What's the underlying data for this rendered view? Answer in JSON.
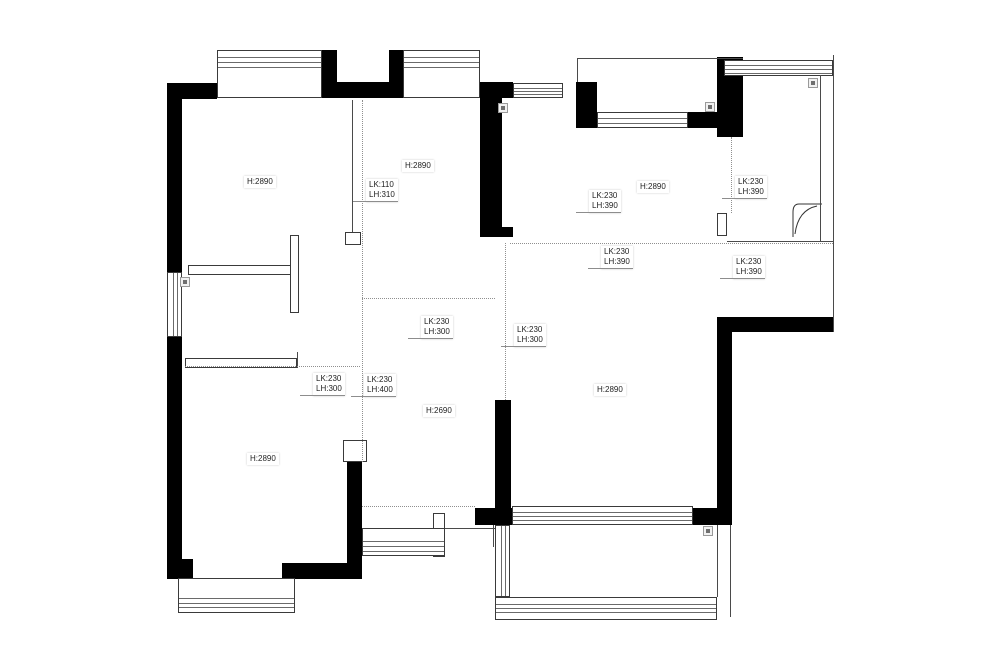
{
  "floorplan": {
    "background_color": "#ffffff",
    "wall_color": "#000000",
    "line_color": "#4a4a4a",
    "labels": [
      {
        "name": "height-topleft-bedroom",
        "lines": [
          "H:2890"
        ],
        "x": 244,
        "y": 176,
        "leader": false
      },
      {
        "name": "height-topmiddle-room",
        "lines": [
          "H:2890"
        ],
        "x": 402,
        "y": 160,
        "leader": false
      },
      {
        "name": "beam-topmiddle",
        "lines": [
          "LK:110",
          "LH:310"
        ],
        "x": 366,
        "y": 179,
        "leader": true
      },
      {
        "name": "beam-entry",
        "lines": [
          "LK:230",
          "LH:390"
        ],
        "x": 589,
        "y": 190,
        "leader": true
      },
      {
        "name": "height-topright-hall",
        "lines": [
          "H:2890"
        ],
        "x": 637,
        "y": 181,
        "leader": false
      },
      {
        "name": "beam-topright-room",
        "lines": [
          "LK:230",
          "LH:390"
        ],
        "x": 735,
        "y": 176,
        "leader": true
      },
      {
        "name": "beam-center",
        "lines": [
          "LK:230",
          "LH:390"
        ],
        "x": 601,
        "y": 246,
        "leader": true
      },
      {
        "name": "beam-right-bath",
        "lines": [
          "LK:230",
          "LH:390"
        ],
        "x": 733,
        "y": 256,
        "leader": true
      },
      {
        "name": "beam-middle-1",
        "lines": [
          "LK:230",
          "LH:300"
        ],
        "x": 421,
        "y": 316,
        "leader": true
      },
      {
        "name": "beam-middle-2",
        "lines": [
          "LK:230",
          "LH:300"
        ],
        "x": 514,
        "y": 324,
        "leader": true
      },
      {
        "name": "beam-left-1",
        "lines": [
          "LK:230",
          "LH:300"
        ],
        "x": 313,
        "y": 373,
        "leader": true
      },
      {
        "name": "beam-left-2",
        "lines": [
          "LK:230",
          "LH:400"
        ],
        "x": 364,
        "y": 374,
        "leader": true
      },
      {
        "name": "height-dining-passage",
        "lines": [
          "H:2690"
        ],
        "x": 423,
        "y": 405,
        "leader": false
      },
      {
        "name": "height-living-room",
        "lines": [
          "H:2890"
        ],
        "x": 594,
        "y": 384,
        "leader": false
      },
      {
        "name": "height-bottomleft-bedroom",
        "lines": [
          "H:2890"
        ],
        "x": 247,
        "y": 453,
        "leader": false
      }
    ],
    "walls": [
      [
        167,
        83,
        50,
        16
      ],
      [
        167,
        83,
        15,
        192
      ],
      [
        167,
        337,
        15,
        226
      ],
      [
        322,
        50,
        15,
        48
      ],
      [
        337,
        82,
        52,
        16
      ],
      [
        389,
        50,
        14,
        48
      ],
      [
        480,
        82,
        33,
        16
      ],
      [
        480,
        82,
        22,
        155
      ],
      [
        480,
        227,
        33,
        10
      ],
      [
        576,
        82,
        21,
        46
      ],
      [
        688,
        112,
        30,
        16
      ],
      [
        717,
        57,
        26,
        80
      ],
      [
        717,
        317,
        116,
        15
      ],
      [
        717,
        317,
        15,
        206
      ],
      [
        693,
        508,
        39,
        17
      ],
      [
        475,
        508,
        37,
        17
      ],
      [
        495,
        400,
        16,
        108
      ],
      [
        347,
        462,
        15,
        117
      ],
      [
        282,
        563,
        80,
        16
      ],
      [
        167,
        559,
        26,
        20
      ]
    ],
    "windows": [
      {
        "x": 217,
        "y": 50,
        "w": 105,
        "h": 48,
        "dir": "h",
        "off": [
          6,
          11,
          16
        ]
      },
      {
        "x": 403,
        "y": 50,
        "w": 77,
        "h": 48,
        "dir": "h",
        "off": [
          6,
          11,
          16
        ]
      },
      {
        "x": 513,
        "y": 83,
        "w": 50,
        "h": 15,
        "dir": "h",
        "off": [
          4,
          7,
          10
        ]
      },
      {
        "x": 597,
        "y": 112,
        "w": 91,
        "h": 16,
        "dir": "h",
        "off": [
          5,
          10
        ]
      },
      {
        "x": 724,
        "y": 60,
        "w": 109,
        "h": 16,
        "dir": "h",
        "off": [
          4,
          8,
          12
        ]
      },
      {
        "x": 167,
        "y": 272,
        "w": 15,
        "h": 65,
        "dir": "v",
        "off": [
          5,
          9
        ]
      },
      {
        "x": 178,
        "y": 578,
        "w": 117,
        "h": 35,
        "dir": "h",
        "off": [
          19,
          24,
          28
        ]
      },
      {
        "x": 362,
        "y": 528,
        "w": 83,
        "h": 28,
        "dir": "h",
        "off": [
          12,
          17,
          22
        ]
      },
      {
        "x": 495,
        "y": 525,
        "w": 15,
        "h": 72,
        "dir": "v",
        "off": [
          5,
          9
        ]
      },
      {
        "x": 495,
        "y": 597,
        "w": 222,
        "h": 23,
        "dir": "h",
        "off": [
          6,
          10,
          14
        ]
      },
      {
        "x": 512,
        "y": 506,
        "w": 181,
        "h": 19,
        "dir": "h",
        "off": [
          5,
          9,
          13
        ]
      }
    ],
    "outlines": [
      [
        188,
        265,
        105,
        10
      ],
      [
        290,
        235,
        9,
        78
      ],
      [
        185,
        358,
        112,
        10
      ],
      [
        345,
        232,
        16,
        13
      ],
      [
        343,
        440,
        24,
        22
      ],
      [
        717,
        213,
        10,
        23
      ],
      [
        433,
        513,
        12,
        44
      ],
      [
        495,
        603,
        32,
        15
      ],
      [
        688,
        603,
        14,
        15
      ]
    ],
    "solid_lines": [
      [
        577,
        58,
        743,
        58
      ],
      [
        577,
        58,
        577,
        82
      ],
      [
        833,
        55,
        833,
        332
      ],
      [
        820,
        75,
        820,
        241
      ],
      [
        727,
        241,
        833,
        241
      ],
      [
        352,
        100,
        352,
        232
      ],
      [
        445,
        528,
        495,
        528
      ],
      [
        493,
        525,
        493,
        547
      ],
      [
        717,
        525,
        717,
        597
      ],
      [
        730,
        525,
        730,
        617
      ],
      [
        297,
        352,
        297,
        368
      ]
    ],
    "dashed_lines": [
      [
        362,
        100,
        362,
        462
      ],
      [
        510,
        243,
        833,
        243
      ],
      [
        505,
        243,
        505,
        400
      ],
      [
        362,
        298,
        495,
        298
      ],
      [
        185,
        366,
        360,
        366
      ],
      [
        731,
        137,
        731,
        213
      ],
      [
        362,
        506,
        475,
        506
      ]
    ],
    "markers": [
      [
        180,
        277
      ],
      [
        498,
        103
      ],
      [
        705,
        102
      ],
      [
        808,
        78
      ],
      [
        703,
        526
      ]
    ],
    "door_arc_paths": [
      "M 822 204 L 799 204 Q 793 204 793 212 L 793 237",
      "M 817 206 Q 798 210 795 234"
    ]
  }
}
